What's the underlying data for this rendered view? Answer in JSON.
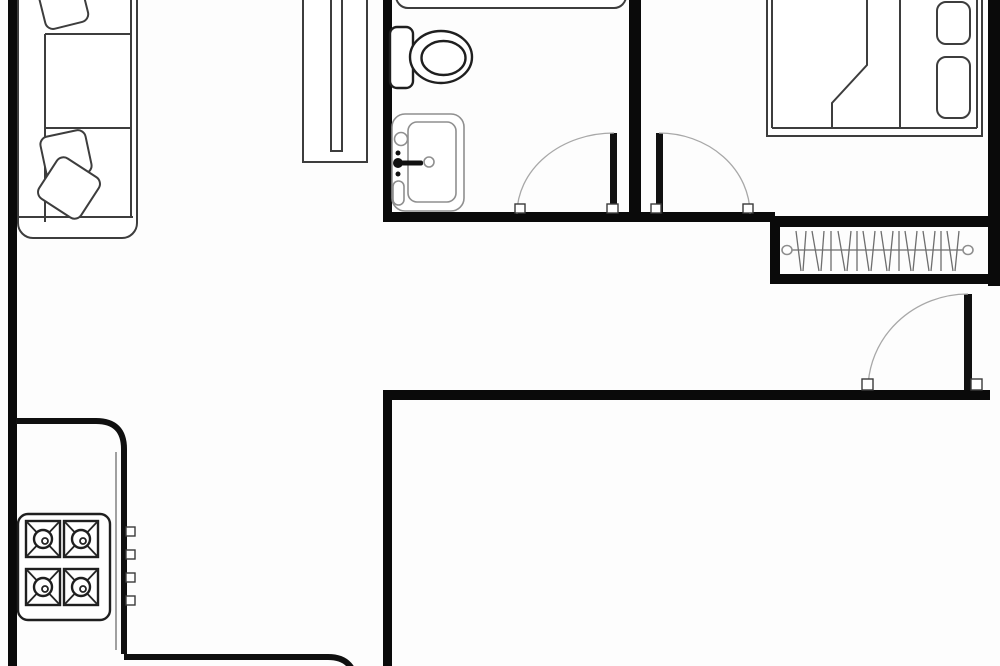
{
  "meta": {
    "title": "apartment-floor-plan",
    "canvas_width": 1000,
    "canvas_height": 666,
    "background_color": "#fdfdfd",
    "wall_color": "#0a0a0a",
    "furniture_stroke_color": "#3d3d3d",
    "door_arc_color": "#a8a8a8"
  },
  "elements": [
    {
      "t": "rect",
      "name": "wall-left-exterior",
      "cls": "wall",
      "a": {
        "x": 8,
        "y": 0,
        "width": 9,
        "height": 666
      }
    },
    {
      "t": "rect",
      "name": "wall-bathroom-left",
      "cls": "wall",
      "a": {
        "x": 383,
        "y": 0,
        "width": 9,
        "height": 222
      }
    },
    {
      "t": "rect",
      "name": "wall-bathroom-bedroom-divider",
      "cls": "wall",
      "a": {
        "x": 629,
        "y": 0,
        "width": 12,
        "height": 222
      }
    },
    {
      "t": "rect",
      "name": "wall-bathroom-bedroom-bottom",
      "cls": "wall",
      "a": {
        "x": 383,
        "y": 212,
        "width": 392,
        "height": 10
      }
    },
    {
      "t": "rect",
      "name": "wall-closet-top",
      "cls": "wall",
      "a": {
        "x": 770,
        "y": 216,
        "width": 230,
        "height": 11
      }
    },
    {
      "t": "rect",
      "name": "wall-closet-left",
      "cls": "wall",
      "a": {
        "x": 770,
        "y": 216,
        "width": 10,
        "height": 68
      }
    },
    {
      "t": "rect",
      "name": "wall-closet-bottom",
      "cls": "wall",
      "a": {
        "x": 770,
        "y": 274,
        "width": 222,
        "height": 10
      }
    },
    {
      "t": "rect",
      "name": "wall-right-exterior",
      "cls": "wall",
      "a": {
        "x": 988,
        "y": 0,
        "width": 12,
        "height": 286
      }
    },
    {
      "t": "rect",
      "name": "wall-entry-bottom",
      "cls": "wall",
      "a": {
        "x": 383,
        "y": 390,
        "width": 607,
        "height": 10
      }
    },
    {
      "t": "rect",
      "name": "wall-lower-left-vertical",
      "cls": "wall",
      "a": {
        "x": 383,
        "y": 392,
        "width": 9,
        "height": 274
      }
    },
    {
      "t": "rect",
      "name": "sofa-outline",
      "cls": "furn",
      "a": {
        "x": 18,
        "y": -16,
        "width": 119,
        "height": 254,
        "rx": 15
      }
    },
    {
      "t": "line",
      "name": "sofa-back-line",
      "cls": "furnline",
      "a": {
        "x1": 45,
        "y1": 34,
        "x2": 45,
        "y2": 222
      }
    },
    {
      "t": "line",
      "name": "sofa-seat-divider-top",
      "cls": "furnline",
      "a": {
        "x1": 45,
        "y1": 34,
        "x2": 131,
        "y2": 34
      }
    },
    {
      "t": "line",
      "name": "sofa-seat-divider-bottom",
      "cls": "furnline",
      "a": {
        "x1": 45,
        "y1": 128,
        "x2": 131,
        "y2": 128
      }
    },
    {
      "t": "line",
      "name": "sofa-armrest-line",
      "cls": "furnline",
      "a": {
        "x1": 19,
        "y1": 217,
        "x2": 133,
        "y2": 217
      }
    },
    {
      "t": "line",
      "name": "sofa-front-line",
      "cls": "furnline",
      "a": {
        "x1": 131,
        "y1": -10,
        "x2": 131,
        "y2": 217
      }
    },
    {
      "t": "rect",
      "name": "sofa-cushion-top",
      "cls": "furn",
      "a": {
        "x": 41,
        "y": -20,
        "width": 44,
        "height": 46,
        "rx": 8,
        "transform": "rotate(-14 63 3)"
      }
    },
    {
      "t": "rect",
      "name": "sofa-cushion-middle",
      "cls": "furn",
      "a": {
        "x": 43,
        "y": 133,
        "width": 46,
        "height": 44,
        "rx": 8,
        "transform": "rotate(-12 66 155)"
      }
    },
    {
      "t": "rect",
      "name": "sofa-cushion-bottom",
      "cls": "furn",
      "a": {
        "x": 44,
        "y": 164,
        "width": 50,
        "height": 48,
        "rx": 8,
        "transform": "rotate(33 69 188)"
      }
    },
    {
      "t": "rect",
      "name": "wardrobe-cabinet-outline",
      "cls": "furn",
      "a": {
        "x": 303,
        "y": -10,
        "width": 64,
        "height": 172
      }
    },
    {
      "t": "rect",
      "name": "wardrobe-cabinet-slot",
      "cls": "furn",
      "a": {
        "x": 331,
        "y": -10,
        "width": 11,
        "height": 161
      }
    },
    {
      "t": "rect",
      "name": "bathtub",
      "cls": "furn",
      "a": {
        "x": 396,
        "y": -38,
        "width": 230,
        "height": 46,
        "rx": 12
      }
    },
    {
      "t": "rect",
      "name": "toilet-tank",
      "cls": "furn-dark",
      "a": {
        "x": 390,
        "y": 27,
        "width": 23,
        "height": 61,
        "rx": 7
      }
    },
    {
      "t": "ellipse",
      "name": "toilet-bowl-outer",
      "cls": "furn-dark",
      "a": {
        "cx": 441,
        "cy": 57,
        "rx": 31,
        "ry": 26
      }
    },
    {
      "t": "ellipse",
      "name": "toilet-bowl-inner",
      "cls": "furn-dark",
      "a": {
        "cx": 443.5,
        "cy": 58,
        "rx": 22,
        "ry": 17
      }
    },
    {
      "t": "rect",
      "name": "sink-outline",
      "cls": "furn-light",
      "a": {
        "x": 392,
        "y": 114,
        "width": 72,
        "height": 97,
        "rx": 13
      }
    },
    {
      "t": "rect",
      "name": "sink-basin",
      "cls": "furn-light",
      "a": {
        "x": 408,
        "y": 122,
        "width": 48,
        "height": 80,
        "rx": 9
      }
    },
    {
      "t": "circle",
      "name": "sink-corner-hole",
      "cls": "furn-light",
      "a": {
        "cx": 401,
        "cy": 139,
        "r": 6.5
      }
    },
    {
      "t": "circle",
      "name": "sink-dot-top",
      "cls": "blackfill",
      "a": {
        "cx": 398,
        "cy": 153,
        "r": 2.5
      }
    },
    {
      "t": "circle",
      "name": "sink-faucet-knob",
      "cls": "blackfill",
      "a": {
        "cx": 398,
        "cy": 163,
        "r": 5
      }
    },
    {
      "t": "rect",
      "name": "sink-faucet-bar",
      "cls": "blackfill",
      "a": {
        "x": 398,
        "y": 160.5,
        "width": 25,
        "height": 5,
        "rx": 2
      }
    },
    {
      "t": "circle",
      "name": "sink-dot-bottom",
      "cls": "blackfill",
      "a": {
        "cx": 398,
        "cy": 174,
        "r": 2.5
      }
    },
    {
      "t": "circle",
      "name": "sink-drain",
      "cls": "furn-light",
      "a": {
        "cx": 429,
        "cy": 162,
        "r": 5
      }
    },
    {
      "t": "rect",
      "name": "sink-soap-dish",
      "cls": "furn-light",
      "a": {
        "x": 393,
        "y": 181,
        "width": 11,
        "height": 24,
        "rx": 5.5
      }
    },
    {
      "t": "rect",
      "name": "bed-frame",
      "cls": "furn",
      "a": {
        "x": 767,
        "y": -12,
        "width": 215,
        "height": 148
      }
    },
    {
      "t": "line",
      "name": "bed-inner-left",
      "cls": "furnline",
      "a": {
        "x1": 772,
        "y1": -8,
        "x2": 772,
        "y2": 128
      }
    },
    {
      "t": "line",
      "name": "bed-inner-bottom",
      "cls": "furnline",
      "a": {
        "x1": 772,
        "y1": 128,
        "x2": 977,
        "y2": 128
      }
    },
    {
      "t": "line",
      "name": "bed-inner-right",
      "cls": "furnline",
      "a": {
        "x1": 977,
        "y1": -8,
        "x2": 977,
        "y2": 128
      }
    },
    {
      "t": "line",
      "name": "bed-pillow-divider",
      "cls": "furnline",
      "a": {
        "x1": 900,
        "y1": -8,
        "x2": 900,
        "y2": 128
      }
    },
    {
      "t": "polyline",
      "name": "bed-blanket-fold",
      "cls": "furnline",
      "a": {
        "points": "867,-8 867,65 832,103 832,128"
      }
    },
    {
      "t": "rect",
      "name": "bed-pillow-top",
      "cls": "furn",
      "a": {
        "x": 937,
        "y": 2,
        "width": 33,
        "height": 42,
        "rx": 9
      }
    },
    {
      "t": "rect",
      "name": "bed-pillow-bottom",
      "cls": "furn",
      "a": {
        "x": 937,
        "y": 57,
        "width": 33,
        "height": 61,
        "rx": 9
      }
    },
    {
      "t": "line",
      "name": "closet-rod",
      "cls": "hairline",
      "a": {
        "x1": 787,
        "y1": 250,
        "x2": 968,
        "y2": 250
      }
    },
    {
      "t": "ellipse",
      "name": "closet-rod-end-left",
      "cls": "furn-light",
      "a": {
        "cx": 787,
        "cy": 250,
        "rx": 5,
        "ry": 4.5
      }
    },
    {
      "t": "ellipse",
      "name": "closet-rod-end-right",
      "cls": "furn-light",
      "a": {
        "cx": 968,
        "cy": 250,
        "rx": 5,
        "ry": 4.5
      }
    },
    {
      "t": "line",
      "name": "hanger-line",
      "cls": "hairline",
      "a": {
        "x1": 796,
        "y1": 231,
        "x2": 801,
        "y2": 271
      }
    },
    {
      "t": "line",
      "name": "hanger-line",
      "cls": "hairline",
      "a": {
        "x1": 806,
        "y1": 231,
        "x2": 803,
        "y2": 271
      }
    },
    {
      "t": "line",
      "name": "hanger-line",
      "cls": "hairline",
      "a": {
        "x1": 812,
        "y1": 231,
        "x2": 819,
        "y2": 271
      }
    },
    {
      "t": "line",
      "name": "hanger-line",
      "cls": "hairline",
      "a": {
        "x1": 824,
        "y1": 231,
        "x2": 821,
        "y2": 271
      }
    },
    {
      "t": "line",
      "name": "hanger-line",
      "cls": "hairline",
      "a": {
        "x1": 831,
        "y1": 231,
        "x2": 831,
        "y2": 271
      }
    },
    {
      "t": "line",
      "name": "hanger-line",
      "cls": "hairline",
      "a": {
        "x1": 838,
        "y1": 231,
        "x2": 845,
        "y2": 271
      }
    },
    {
      "t": "line",
      "name": "hanger-line",
      "cls": "hairline",
      "a": {
        "x1": 851,
        "y1": 231,
        "x2": 847,
        "y2": 271
      }
    },
    {
      "t": "line",
      "name": "hanger-line",
      "cls": "hairline",
      "a": {
        "x1": 857,
        "y1": 231,
        "x2": 857,
        "y2": 271
      }
    },
    {
      "t": "line",
      "name": "hanger-line",
      "cls": "hairline",
      "a": {
        "x1": 863,
        "y1": 231,
        "x2": 869,
        "y2": 271
      }
    },
    {
      "t": "line",
      "name": "hanger-line",
      "cls": "hairline",
      "a": {
        "x1": 875,
        "y1": 231,
        "x2": 871,
        "y2": 271
      }
    },
    {
      "t": "line",
      "name": "hanger-line",
      "cls": "hairline",
      "a": {
        "x1": 881,
        "y1": 231,
        "x2": 887,
        "y2": 271
      }
    },
    {
      "t": "line",
      "name": "hanger-line",
      "cls": "hairline",
      "a": {
        "x1": 893,
        "y1": 231,
        "x2": 889,
        "y2": 271
      }
    },
    {
      "t": "line",
      "name": "hanger-line",
      "cls": "hairline",
      "a": {
        "x1": 899,
        "y1": 231,
        "x2": 899,
        "y2": 271
      }
    },
    {
      "t": "line",
      "name": "hanger-line",
      "cls": "hairline",
      "a": {
        "x1": 905,
        "y1": 231,
        "x2": 911,
        "y2": 271
      }
    },
    {
      "t": "line",
      "name": "hanger-line",
      "cls": "hairline",
      "a": {
        "x1": 917,
        "y1": 231,
        "x2": 913,
        "y2": 271
      }
    },
    {
      "t": "line",
      "name": "hanger-line",
      "cls": "hairline",
      "a": {
        "x1": 923,
        "y1": 231,
        "x2": 929,
        "y2": 271
      }
    },
    {
      "t": "line",
      "name": "hanger-line",
      "cls": "hairline",
      "a": {
        "x1": 935,
        "y1": 231,
        "x2": 931,
        "y2": 271
      }
    },
    {
      "t": "line",
      "name": "hanger-line",
      "cls": "hairline",
      "a": {
        "x1": 941,
        "y1": 231,
        "x2": 941,
        "y2": 271
      }
    },
    {
      "t": "line",
      "name": "hanger-line",
      "cls": "hairline",
      "a": {
        "x1": 947,
        "y1": 231,
        "x2": 953,
        "y2": 271
      }
    },
    {
      "t": "line",
      "name": "hanger-line",
      "cls": "hairline",
      "a": {
        "x1": 959,
        "y1": 231,
        "x2": 955,
        "y2": 271
      }
    },
    {
      "t": "rect",
      "name": "bathroom-door-leaf",
      "cls": "blackfill",
      "a": {
        "x": 610,
        "y": 133,
        "width": 7,
        "height": 81
      }
    },
    {
      "t": "path",
      "name": "bathroom-door-arc",
      "cls": "arc",
      "a": {
        "d": "M614,133 A97,81 0 0 0 517,214"
      }
    },
    {
      "t": "rect",
      "name": "bathroom-door-jamb-left",
      "cls": "jamb",
      "a": {
        "x": 515,
        "y": 204,
        "width": 10,
        "height": 9
      }
    },
    {
      "t": "rect",
      "name": "bathroom-door-jamb-right",
      "cls": "jamb",
      "a": {
        "x": 607,
        "y": 204,
        "width": 11,
        "height": 9
      }
    },
    {
      "t": "rect",
      "name": "bedroom-door-leaf",
      "cls": "blackfill",
      "a": {
        "x": 656,
        "y": 133,
        "width": 7,
        "height": 81
      }
    },
    {
      "t": "path",
      "name": "bedroom-door-arc",
      "cls": "arc",
      "a": {
        "d": "M659,133 A91,81 0 0 1 750,214"
      }
    },
    {
      "t": "rect",
      "name": "bedroom-door-jamb-left",
      "cls": "jamb",
      "a": {
        "x": 651,
        "y": 204,
        "width": 10,
        "height": 9
      }
    },
    {
      "t": "rect",
      "name": "bedroom-door-jamb-right",
      "cls": "jamb",
      "a": {
        "x": 743,
        "y": 204,
        "width": 10,
        "height": 9
      }
    },
    {
      "t": "rect",
      "name": "entry-door-leaf",
      "cls": "blackfill",
      "a": {
        "x": 964,
        "y": 294,
        "width": 8,
        "height": 96
      }
    },
    {
      "t": "path",
      "name": "entry-door-arc",
      "cls": "arc",
      "a": {
        "d": "M968,294 A100,96 0 0 0 868,390"
      }
    },
    {
      "t": "rect",
      "name": "entry-door-jamb-left",
      "cls": "jamb",
      "a": {
        "x": 862,
        "y": 379,
        "width": 11,
        "height": 11
      }
    },
    {
      "t": "rect",
      "name": "entry-door-jamb-right",
      "cls": "jamb",
      "a": {
        "x": 971,
        "y": 379,
        "width": 11,
        "height": 11
      }
    },
    {
      "t": "path",
      "name": "kitchen-counter-edge",
      "cls": "counter",
      "a": {
        "d": "M16,421 H96 Q124,421 124,449 V654"
      }
    },
    {
      "t": "line",
      "name": "kitchen-counter-inner-line",
      "cls": "hairline",
      "a": {
        "x1": 116,
        "y1": 452,
        "x2": 116,
        "y2": 650
      }
    },
    {
      "t": "rect",
      "name": "counter-knob",
      "cls": "jamb",
      "a": {
        "x": 126,
        "y": 527,
        "width": 9,
        "height": 9
      }
    },
    {
      "t": "rect",
      "name": "counter-knob",
      "cls": "jamb",
      "a": {
        "x": 126,
        "y": 550,
        "width": 9,
        "height": 9
      }
    },
    {
      "t": "rect",
      "name": "counter-knob",
      "cls": "jamb",
      "a": {
        "x": 126,
        "y": 573,
        "width": 9,
        "height": 9
      }
    },
    {
      "t": "rect",
      "name": "counter-knob",
      "cls": "jamb",
      "a": {
        "x": 126,
        "y": 596,
        "width": 9,
        "height": 9
      }
    },
    {
      "t": "rect",
      "name": "stove-outline",
      "cls": "furn-dark",
      "a": {
        "x": 18,
        "y": 514,
        "width": 92,
        "height": 106,
        "rx": 10
      }
    },
    {
      "t": "rect",
      "name": "stove-burner-frame",
      "cls": "furn-dark",
      "a": {
        "x": 26,
        "y": 521,
        "width": 34,
        "height": 36
      }
    },
    {
      "t": "rect",
      "name": "stove-burner-frame",
      "cls": "furn-dark",
      "a": {
        "x": 64,
        "y": 521,
        "width": 34,
        "height": 36
      }
    },
    {
      "t": "rect",
      "name": "stove-burner-frame",
      "cls": "furn-dark",
      "a": {
        "x": 26,
        "y": 569,
        "width": 34,
        "height": 36
      }
    },
    {
      "t": "rect",
      "name": "stove-burner-frame",
      "cls": "furn-dark",
      "a": {
        "x": 64,
        "y": 569,
        "width": 34,
        "height": 36
      }
    },
    {
      "t": "line",
      "name": "stove-burner-cross",
      "cls": "xline",
      "a": {
        "x1": 26,
        "y1": 521,
        "x2": 60,
        "y2": 557
      }
    },
    {
      "t": "line",
      "name": "stove-burner-cross",
      "cls": "xline",
      "a": {
        "x1": 60,
        "y1": 521,
        "x2": 26,
        "y2": 557
      }
    },
    {
      "t": "line",
      "name": "stove-burner-cross",
      "cls": "xline",
      "a": {
        "x1": 64,
        "y1": 521,
        "x2": 98,
        "y2": 557
      }
    },
    {
      "t": "line",
      "name": "stove-burner-cross",
      "cls": "xline",
      "a": {
        "x1": 98,
        "y1": 521,
        "x2": 64,
        "y2": 557
      }
    },
    {
      "t": "line",
      "name": "stove-burner-cross",
      "cls": "xline",
      "a": {
        "x1": 26,
        "y1": 569,
        "x2": 60,
        "y2": 605
      }
    },
    {
      "t": "line",
      "name": "stove-burner-cross",
      "cls": "xline",
      "a": {
        "x1": 60,
        "y1": 569,
        "x2": 26,
        "y2": 605
      }
    },
    {
      "t": "line",
      "name": "stove-burner-cross",
      "cls": "xline",
      "a": {
        "x1": 64,
        "y1": 569,
        "x2": 98,
        "y2": 605
      }
    },
    {
      "t": "line",
      "name": "stove-burner-cross",
      "cls": "xline",
      "a": {
        "x1": 98,
        "y1": 569,
        "x2": 64,
        "y2": 605
      }
    },
    {
      "t": "circle",
      "name": "stove-burner-ring",
      "cls": "furn-dark",
      "a": {
        "cx": 43,
        "cy": 539,
        "r": 9
      }
    },
    {
      "t": "circle",
      "name": "stove-burner-ring",
      "cls": "furn-dark",
      "a": {
        "cx": 81,
        "cy": 539,
        "r": 9
      }
    },
    {
      "t": "circle",
      "name": "stove-burner-ring",
      "cls": "furn-dark",
      "a": {
        "cx": 43,
        "cy": 587,
        "r": 9
      }
    },
    {
      "t": "circle",
      "name": "stove-burner-ring",
      "cls": "furn-dark",
      "a": {
        "cx": 81,
        "cy": 587,
        "r": 9
      }
    },
    {
      "t": "circle",
      "name": "stove-burner-dot",
      "cls": "xline",
      "a": {
        "cx": 45,
        "cy": 541,
        "r": 3
      }
    },
    {
      "t": "circle",
      "name": "stove-burner-dot",
      "cls": "xline",
      "a": {
        "cx": 83,
        "cy": 541,
        "r": 3
      }
    },
    {
      "t": "circle",
      "name": "stove-burner-dot",
      "cls": "xline",
      "a": {
        "cx": 45,
        "cy": 589,
        "r": 3
      }
    },
    {
      "t": "circle",
      "name": "stove-burner-dot",
      "cls": "xline",
      "a": {
        "cx": 83,
        "cy": 589,
        "r": 3
      }
    },
    {
      "t": "path",
      "name": "kitchen-island-edge",
      "cls": "counter",
      "a": {
        "d": "M124,657 H328 Q356,657 356,688"
      }
    }
  ]
}
